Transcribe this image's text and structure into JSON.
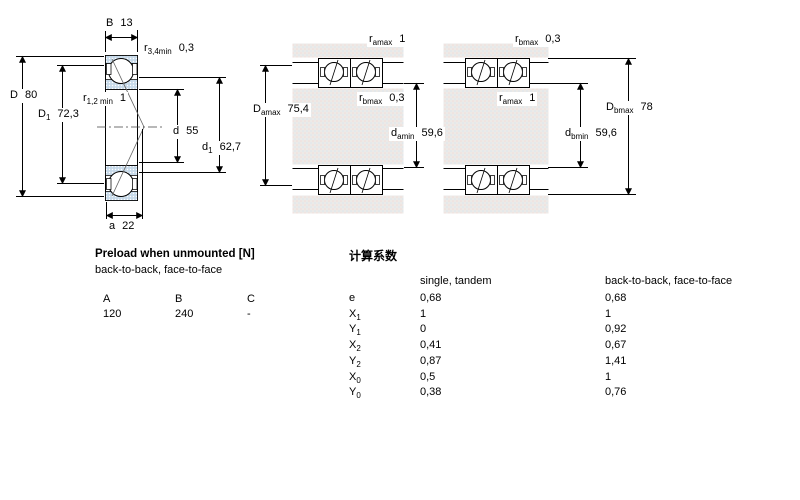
{
  "colors": {
    "line": "#000000",
    "ring_fill": "#c7daea",
    "housing_fill": "#eceae7",
    "ball_fill": "#ffffff"
  },
  "figure_left": {
    "dim_B": {
      "sym": "B",
      "val": "13"
    },
    "dim_r34": {
      "sym": "r",
      "sub": "3,4min",
      "val": "0,3"
    },
    "dim_D": {
      "sym": "D",
      "val": "80"
    },
    "dim_D1": {
      "sym": "D",
      "sub": "1",
      "val": "72,3"
    },
    "dim_r12": {
      "sym": "r",
      "sub": "1,2 min",
      "val": "1"
    },
    "dim_d": {
      "sym": "d",
      "val": "55"
    },
    "dim_d1": {
      "sym": "d",
      "sub": "1",
      "val": "62,7"
    },
    "dim_a": {
      "sym": "a",
      "val": "22"
    }
  },
  "figure_middle": {
    "dim_ramax": {
      "sym": "r",
      "sub": "amax",
      "val": "1"
    },
    "dim_rbmax": {
      "sym": "r",
      "sub": "bmax",
      "val": "0,3"
    },
    "dim_Damax": {
      "sym": "D",
      "sub": "amax",
      "val": "75,4"
    },
    "dim_damin": {
      "sym": "d",
      "sub": "amin",
      "val": "59,6"
    }
  },
  "figure_right": {
    "dim_rbmax": {
      "sym": "r",
      "sub": "bmax",
      "val": "0,3"
    },
    "dim_ramax": {
      "sym": "r",
      "sub": "amax",
      "val": "1"
    },
    "dim_Dbmax": {
      "sym": "D",
      "sub": "bmax",
      "val": "78"
    },
    "dim_dbmin": {
      "sym": "d",
      "sub": "bmin",
      "val": "59,6"
    }
  },
  "preload": {
    "title": "Preload when unmounted [N]",
    "subtitle": "back-to-back, face-to-face",
    "columns": [
      "A",
      "B",
      "C"
    ],
    "values": [
      "120",
      "240",
      "-"
    ]
  },
  "factors": {
    "title": "计算系数",
    "col1_header": "single, tandem",
    "col2_header": "back-to-back, face-to-face",
    "rows": [
      {
        "sym": "e",
        "sub": "",
        "single": "0,68",
        "btb": "0,68"
      },
      {
        "sym": "X",
        "sub": "1",
        "single": "1",
        "btb": "1"
      },
      {
        "sym": "Y",
        "sub": "1",
        "single": "0",
        "btb": "0,92"
      },
      {
        "sym": "X",
        "sub": "2",
        "single": "0,41",
        "btb": "0,67"
      },
      {
        "sym": "Y",
        "sub": "2",
        "single": "0,87",
        "btb": "1,41"
      },
      {
        "sym": "X",
        "sub": "0",
        "single": "0,5",
        "btb": "1"
      },
      {
        "sym": "Y",
        "sub": "0",
        "single": "0,38",
        "btb": "0,76"
      }
    ]
  }
}
